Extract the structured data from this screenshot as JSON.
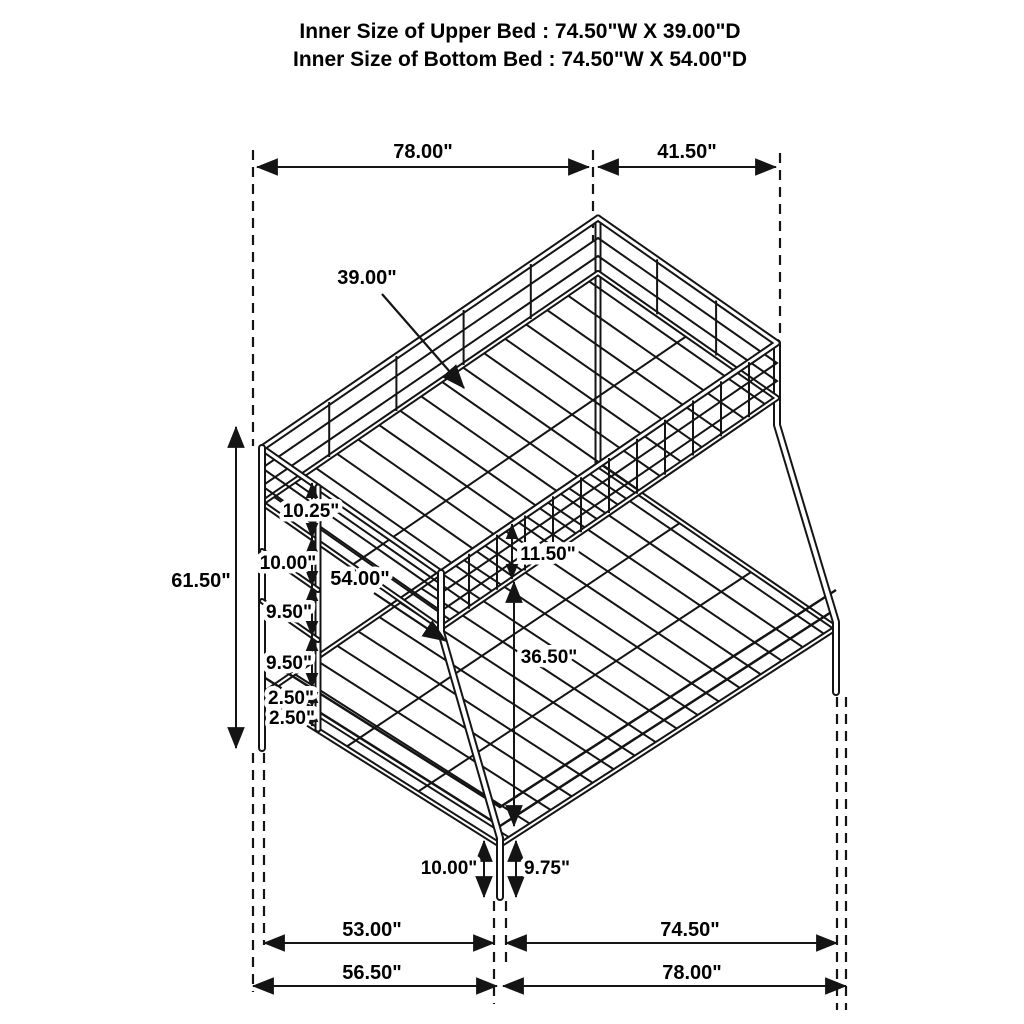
{
  "header": {
    "line1": "Inner Size of Upper Bed : 74.50\"W X 39.00\"D",
    "line2": "Inner Size of Bottom Bed : 74.50\"W X 54.00\"D"
  },
  "drawing": {
    "description": "Isometric wireframe line drawing of a twin-over-full metal bunk bed with side ladder, slat decks and guard rails",
    "line_color": "#141414",
    "background": "#ffffff",
    "dimensions": {
      "top_length": "78.00\"",
      "top_depth": "41.50\"",
      "upper_bed_depth": "39.00\"",
      "overall_height": "61.50\"",
      "rung_spacing_1": "10.25\"",
      "rung_spacing_2": "10.00\"",
      "rung_spacing_3": "9.50\"",
      "rung_spacing_4": "9.50\"",
      "rail_gap_1": "2.50\"",
      "rail_gap_2": "2.50\"",
      "guardrail_height": "11.50\"",
      "lower_bed_depth": "54.00\"",
      "under_clearance": "36.50\"",
      "front_leg_left": "10.00\"",
      "front_leg_right": "9.75\"",
      "floor_left_inner": "53.00\"",
      "floor_right_inner": "74.50\"",
      "floor_left_outer": "56.50\"",
      "floor_right_outer": "78.00\""
    }
  }
}
